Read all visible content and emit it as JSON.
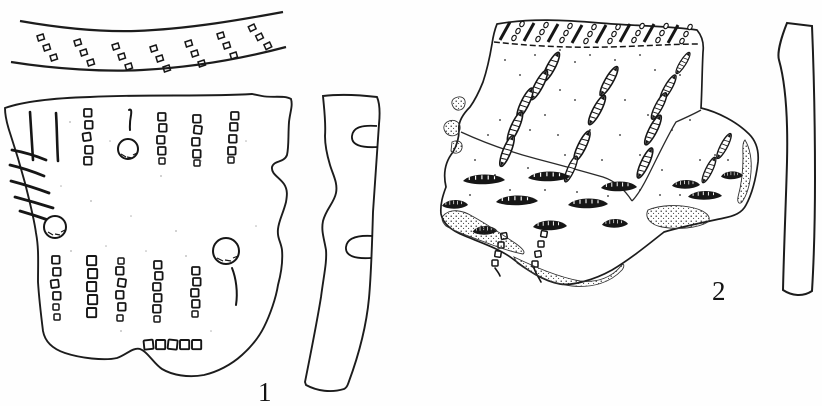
{
  "figure": {
    "type": "archaeological-plate",
    "description": "Scanned line-drawing plate showing two decorated prehistoric pottery sherds, each with a vertical profile section, numbered 1 and 2",
    "ink_color": "#161616",
    "background_color": "#fefefe",
    "labels": {
      "sherd1": "1",
      "sherd2": "2"
    },
    "items": [
      {
        "name": "rim-band-top-view",
        "description": "Curved rim band seen from above, decorated with seven diagonal triplets of small stamped impressions"
      },
      {
        "name": "sherd-1",
        "label": "1",
        "description": "Large body sherd with vertical columns of small square comb impressions, two long incised strokes, diagonal hatching on the broken left edge, three round holes and a bottom horizontal row of squares"
      },
      {
        "name": "sherd-1-profile",
        "description": "S-curved vertical cross-section of sherd 1 with two rounded notches on its right side"
      },
      {
        "name": "sherd-2",
        "label": "2",
        "description": "Rim sherd group of three joining fragments: hatched and beaded rim band, diagonal seed-shaped segmented impressions, rows of black crescent impressions, stippled broken edges and scattered dots"
      },
      {
        "name": "sherd-2-profile",
        "description": "Nearly straight, slightly bevelled vertical cross-section strip of sherd 2"
      }
    ]
  }
}
